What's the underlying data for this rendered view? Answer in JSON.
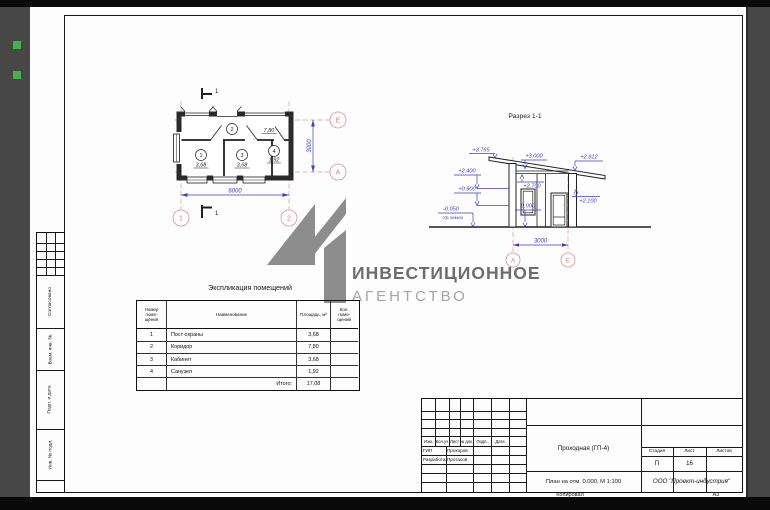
{
  "watermark": {
    "line1": "ИНВЕСТИЦИОННОЕ",
    "line2": "АГЕНТСТВО"
  },
  "plan": {
    "section_mark_top": "1",
    "section_mark_bottom": "1",
    "rooms": [
      {
        "num": "1",
        "area": "3,68"
      },
      {
        "num": "2",
        "area": "7,80"
      },
      {
        "num": "3",
        "area": "3,68"
      },
      {
        "num": "4",
        "area": "1,92"
      }
    ],
    "dim_width": "6000",
    "dim_depth": "3000",
    "axis_1": "1",
    "axis_2": "2",
    "axis_e": "Е",
    "axis_a": "А"
  },
  "section": {
    "title": "Разрез 1-1",
    "elevations": {
      "roof_peak": "+3.765",
      "roof_mid": "+3.000",
      "roof_right": "+2.912",
      "window_head": "+2.400",
      "window_sill": "+0.900",
      "ground": "-0.050",
      "ground_note": "Ур.земли",
      "floor": "0.000",
      "ceiling": "+2.700",
      "door_head": "+2.100"
    },
    "dim_width": "3000",
    "axis_left": "А",
    "axis_right": "Е"
  },
  "explication": {
    "title": "Экспликация помещений",
    "headers": {
      "num": "Номер\nпоме-\nщения",
      "name": "Наименование",
      "area": "Площадь, м²",
      "count": "Кол.\nпоме-\nщений"
    },
    "rows": [
      {
        "num": "1",
        "name": "Пост охраны",
        "area": "3,68"
      },
      {
        "num": "2",
        "name": "Коридор",
        "area": "7,80"
      },
      {
        "num": "3",
        "name": "Кабинет",
        "area": "3,68"
      },
      {
        "num": "4",
        "name": "Санузел",
        "area": "1,92"
      }
    ],
    "total_label": "Итого:",
    "total_value": "17,08"
  },
  "titleblock": {
    "columns": [
      "Изм.",
      "Кол.уч",
      "Лист",
      "№ док.",
      "Подп.",
      "Дата"
    ],
    "signatures": [
      {
        "role": "ГИП",
        "name": "Прохоров"
      },
      {
        "role": "Разработал",
        "name": "Протасов"
      }
    ],
    "project": "Проходная (ГП-4)",
    "drawing_title": "План на отм. 0.000, М 1:100",
    "stage_label": "Стадия",
    "sheet_label": "Лист",
    "sheets_label": "Листов",
    "stage": "П",
    "sheet": "16",
    "sheets": "",
    "company": "ООО \"Проект-индустрия\"",
    "copied": "Копировал",
    "format": "А3"
  },
  "side_stamps": {
    "agreed": "Согласовано",
    "replace": "Взам. инв. №",
    "sign_date": "Подп. и дата",
    "inventory": "Инв. № подл."
  }
}
